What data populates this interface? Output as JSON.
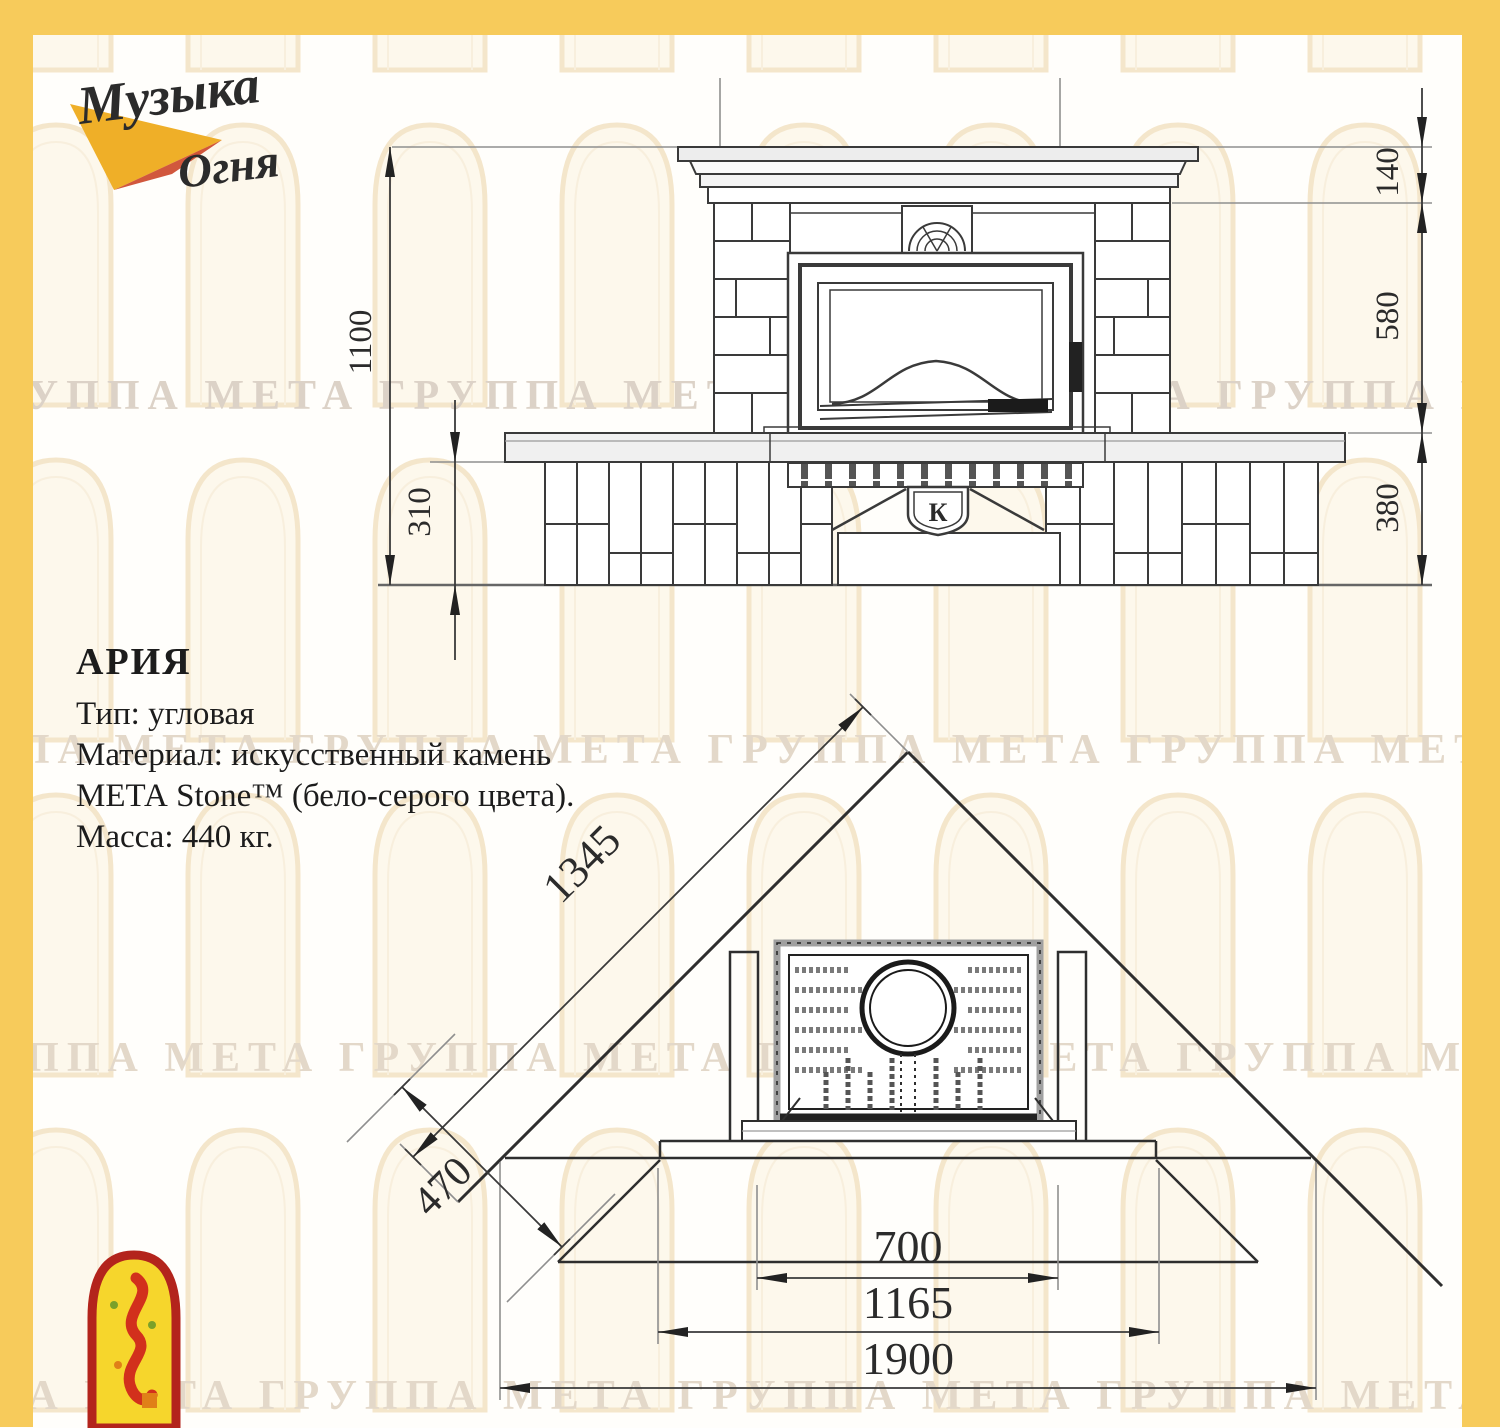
{
  "page": {
    "frame_color": "#F7CB5B"
  },
  "logo": {
    "word1": "Музыка",
    "word2": "Огня"
  },
  "watermark": {
    "row": "ГРУППА МЕТА ГРУППА МЕТА ГРУППА МЕТА ГРУППА МЕТА ГРУППА МЕТА"
  },
  "product": {
    "title": "АРИЯ",
    "type_line": "Тип: угловая",
    "material_line1": "Материал: искусственный камень",
    "material_line2": "МЕТА Stone™ (бело-серого цвета).",
    "mass_line": "Масса: 440 кг."
  },
  "front_view": {
    "badge": "К",
    "dims": {
      "total_height": "1100",
      "hearth_height": "310",
      "mantel_band": "140",
      "middle_band": "580",
      "base_band": "380"
    }
  },
  "plan_view": {
    "dims": {
      "wall_span": "1345",
      "side_face": "470",
      "firebox_opening": "700",
      "front_face": "1165",
      "overall_width": "1900"
    }
  }
}
